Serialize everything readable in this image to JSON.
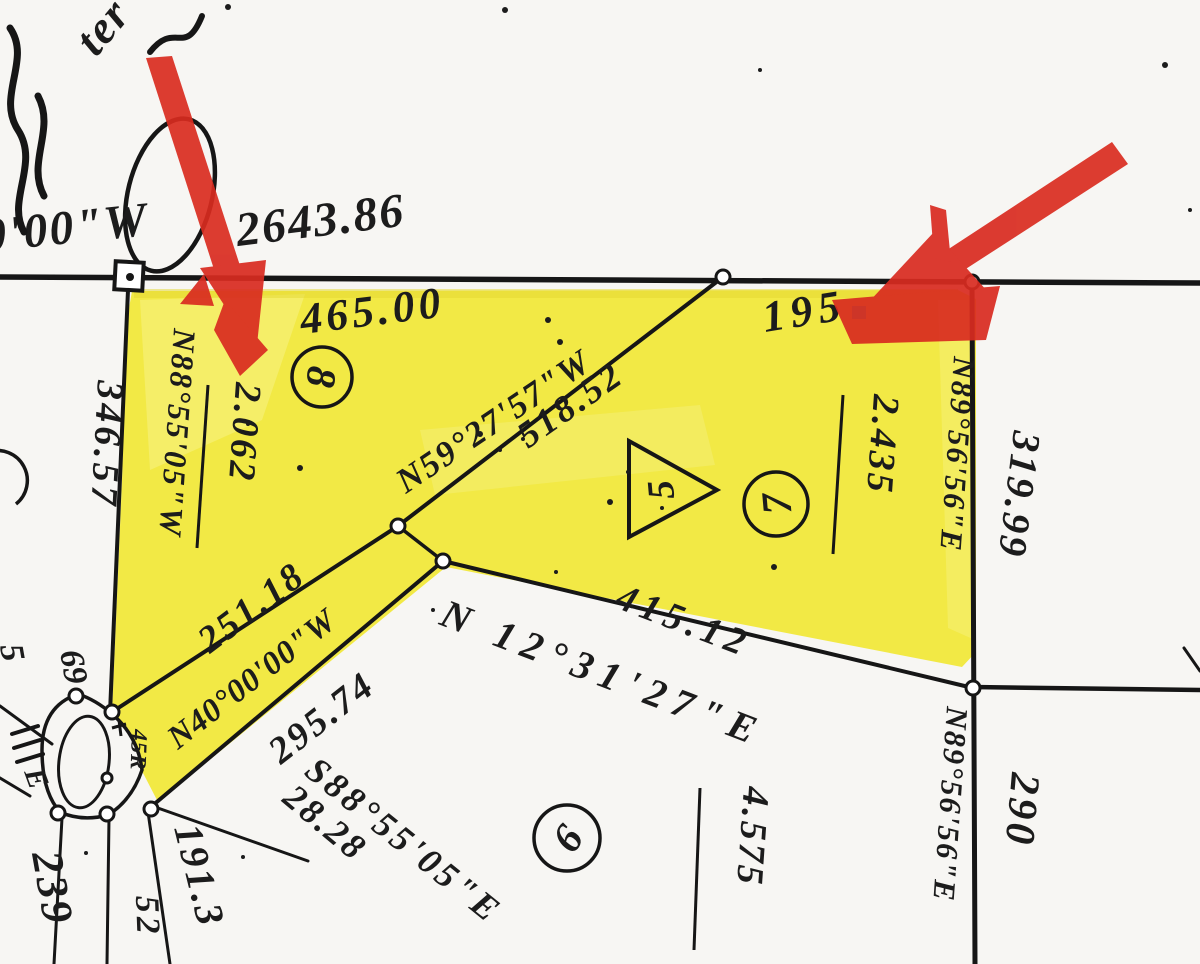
{
  "scan": {
    "highlight_color": "#f2e945",
    "arrow_color": "#d92b20",
    "ink_color": "#1c1c1c",
    "paper_color": "#f7f6f3"
  },
  "section_line": {
    "bearing_fragment": "0'00\"W",
    "distance": "2643.86"
  },
  "north_segments": {
    "lot8_frontage": "465.00",
    "lot7_frontage": "195"
  },
  "west_side": {
    "outside_distance": "346.57",
    "boundary_bearing": "N88°55'05\"W"
  },
  "east_side": {
    "boundary_bearing_upper": "N89°56'56\"E",
    "outside_distance_upper": "319.99",
    "boundary_bearing_lower": "N89°56'56\"E",
    "outside_distance_lower": "290"
  },
  "diagonals": {
    "n59": {
      "bearing": "N59°27'57\"W",
      "distance": "518.52"
    },
    "n40": {
      "bearing": "N40°00'00\"W",
      "distance": "295.74",
      "upper_distance": "251.18"
    },
    "n12": {
      "bearing": "N 12°31'27\"E",
      "distance": "415.12"
    },
    "s88": {
      "bearing": "S88°55'05\"E",
      "distance": "28.28"
    }
  },
  "lots": {
    "lot8": {
      "number": "8",
      "acreage": "2.062"
    },
    "lot7": {
      "number": "7",
      "acreage": "2.435"
    },
    "lot6": {
      "number": "6",
      "acreage": "4.575"
    },
    "parcel5": {
      "number": "5"
    }
  },
  "road": {
    "radius_label": "45R",
    "label_69": "69",
    "label_5": "5",
    "label_e": "E",
    "label_52": "52",
    "label_239": "239",
    "label_191": "191.3"
  },
  "handwriting": {
    "fragment": "ter"
  }
}
